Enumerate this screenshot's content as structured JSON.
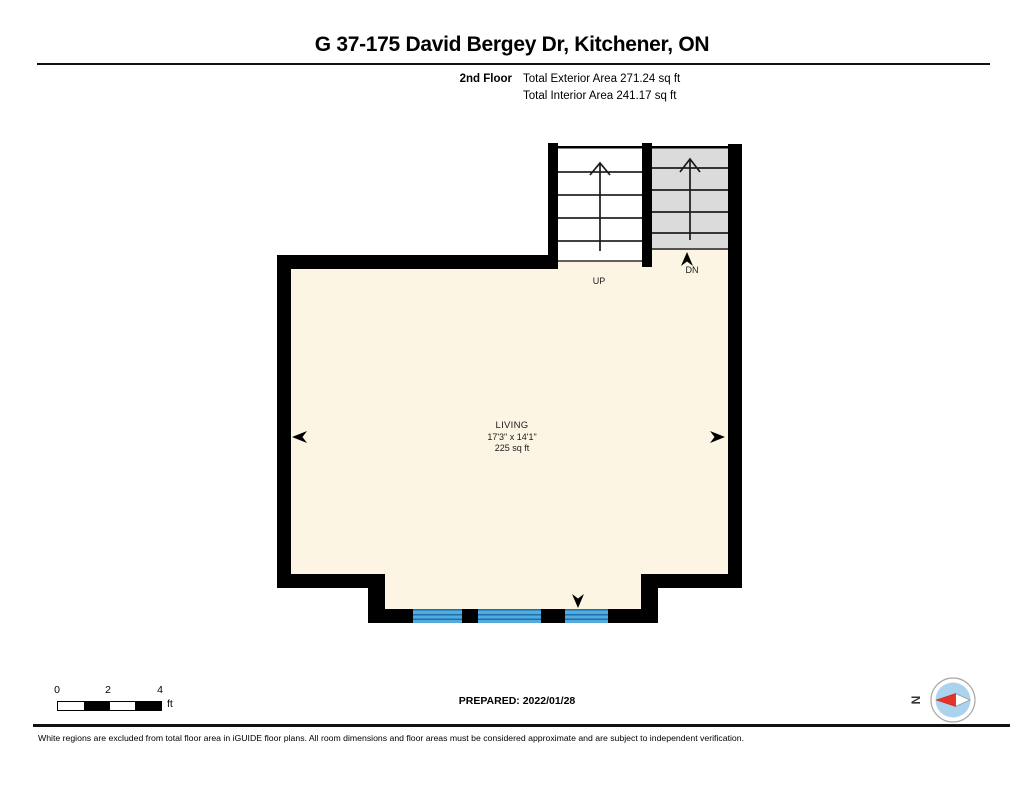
{
  "header": {
    "title": "G 37-175 David Bergey Dr, Kitchener, ON",
    "floor_label": "2nd Floor",
    "total_exterior_area": "Total Exterior Area 271.24 sq ft",
    "total_interior_area": "Total Interior Area 241.17 sq ft"
  },
  "plan": {
    "room": {
      "name": "LIVING",
      "dimensions": "17'3\" x 14'1\"",
      "area": "225 sq ft"
    },
    "stair_up_label": "UP",
    "stair_down_label": "DN",
    "colors": {
      "wall": "#000000",
      "floor_fill": "#FCF5E3",
      "stair_up_fill": "#FFFFFF",
      "stair_down_fill": "#DBDBDB",
      "window_fill": "#54ABDB",
      "window_line": "#1971AE"
    }
  },
  "footer": {
    "scale": {
      "ticks": [
        "0",
        "2",
        "4"
      ],
      "unit": "ft"
    },
    "prepared": "PREPARED: 2022/01/28",
    "compass": {
      "north_label": "N",
      "needle_color": "#E5332A",
      "disc_color": "#ABD3EE"
    },
    "disclaimer": "White regions are excluded from total floor area in iGUIDE floor plans. All room dimensions and floor areas must be considered approximate and are subject to independent verification."
  }
}
